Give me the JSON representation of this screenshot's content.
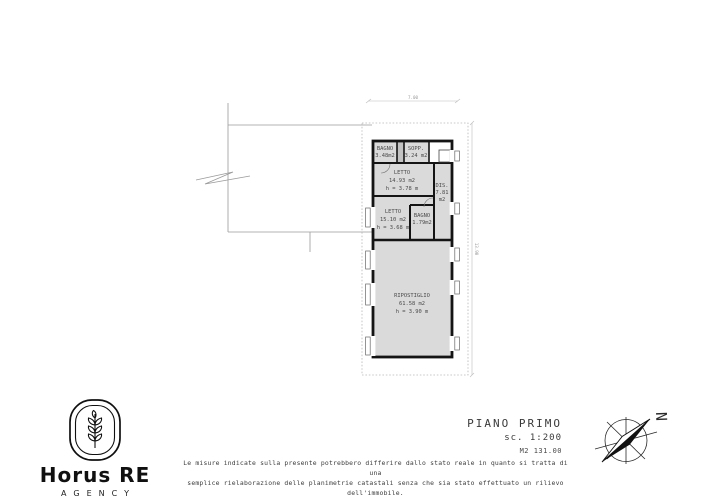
{
  "logo": {
    "brand": "Horus RE",
    "subtitle": "AGENCY"
  },
  "title_block": {
    "floor_label": "PIANO PRIMO",
    "scale": "sc. 1:200",
    "area_total": "M2 131.00"
  },
  "compass": {
    "north_label": "N"
  },
  "disclaimer": {
    "line1": "Le misure indicate sulla presente potrebbero differire dallo stato reale in quanto si tratta di una",
    "line2": "semplice rielaborazione delle planimetrie catastali senza che sia stato effettuato un rilievo dell'immobile."
  },
  "plan": {
    "dim_width": "7.00",
    "dim_height": "13.90",
    "rooms": {
      "bagno1": {
        "name": "BAGNO",
        "area": "3.48m2"
      },
      "sopp": {
        "name": "SOPP.",
        "area": "3.24 m2"
      },
      "letto1": {
        "name": "LETTO",
        "area": "14.93 m2",
        "height": "h = 3.78 m"
      },
      "dis": {
        "name": "DIS.",
        "area": "7.81",
        "unit": "m2"
      },
      "letto2": {
        "name": "LETTO",
        "area": "15.10 m2",
        "height": "h = 3.68 m"
      },
      "bagno2": {
        "name": "BAGNO",
        "area": "1.79m2"
      },
      "ripostiglio": {
        "name": "RIPOSTIGLIO",
        "area": "61.58 m2",
        "height": "h = 3.90 m"
      }
    }
  }
}
